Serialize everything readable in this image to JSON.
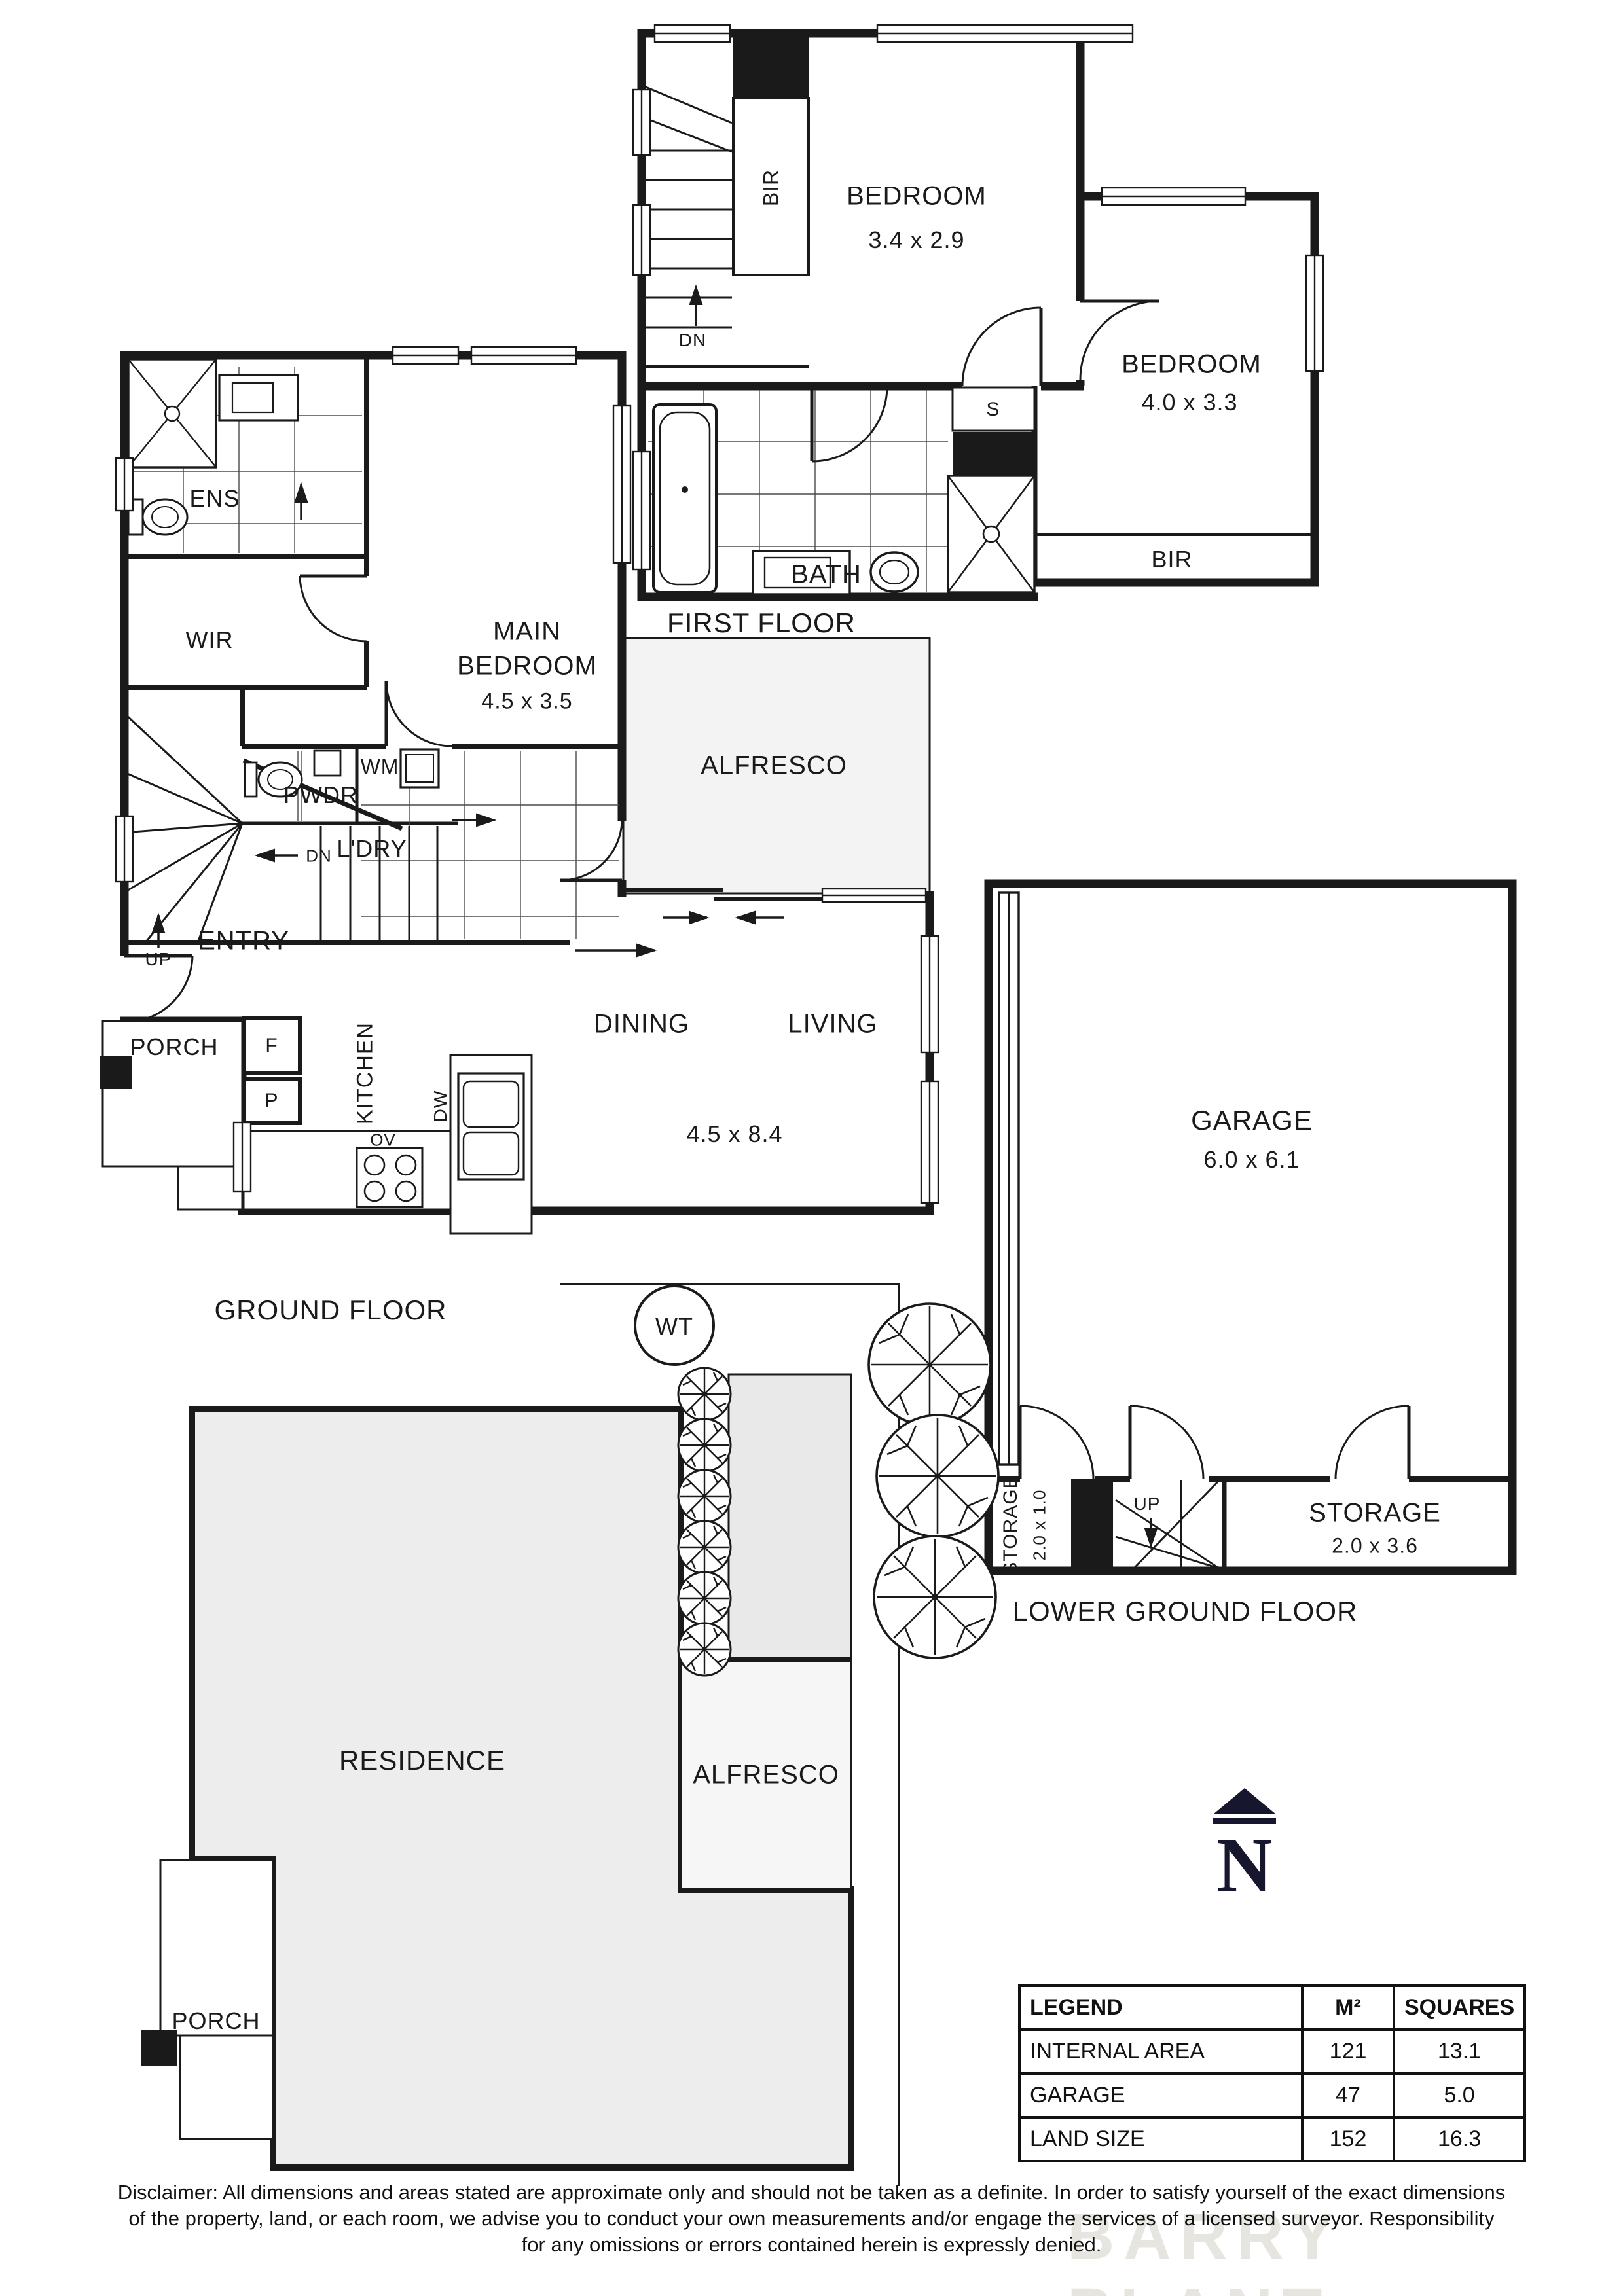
{
  "labels": {
    "ff": {
      "title": "FIRST FLOOR",
      "bedroom1": "BEDROOM",
      "bedroom1_dims": "3.4 x 2.9",
      "bedroom2": "BEDROOM",
      "bedroom2_dims": "4.0 x 3.3",
      "bath": "BATH",
      "bir_stair": "BIR",
      "bir_robe": "BIR",
      "linen": "S",
      "dn": "DN"
    },
    "gf": {
      "title": "GROUND FLOOR",
      "ens": "ENS",
      "wir": "WIR",
      "main_line1": "MAIN",
      "main_line2": "BEDROOM",
      "main_dims": "4.5 x 3.5",
      "pwdr": "PWDR",
      "wm": "WM",
      "ldry": "L'DRY",
      "dn": "DN",
      "up": "UP",
      "entry": "ENTRY",
      "porch": "PORCH",
      "fridge": "F",
      "pantry": "P",
      "kitchen": "KITCHEN",
      "dw": "DW",
      "ov": "OV",
      "dining": "DINING",
      "living": "LIVING",
      "living_dims": "4.5 x 8.4",
      "alfresco": "ALFRESCO"
    },
    "lg": {
      "title": "LOWER GROUND FLOOR",
      "garage": "GARAGE",
      "garage_dims": "6.0 x 6.1",
      "storage1": "STORAGE",
      "storage1_dims": "2.0 x 1.0",
      "up": "UP",
      "storage2": "STORAGE",
      "storage2_dims": "2.0 x 3.6"
    },
    "site": {
      "residence": "RESIDENCE",
      "alfresco": "ALFRESCO",
      "porch": "PORCH",
      "wt": "WT"
    }
  },
  "north": {
    "letter": "N"
  },
  "legend": {
    "headers": [
      "LEGEND",
      "M²",
      "SQUARES"
    ],
    "rows": [
      {
        "label": "INTERNAL AREA",
        "m2": "121",
        "squares": "13.1"
      },
      {
        "label": "GARAGE",
        "m2": "47",
        "squares": "5.0"
      },
      {
        "label": "LAND SIZE",
        "m2": "152",
        "squares": "16.3"
      }
    ]
  },
  "disclaimer": {
    "line1": "Disclaimer: All dimensions and areas stated are approximate only and should not be taken as a definite. In order to satisfy yourself of the exact dimensions",
    "line2": "of the property, land, or each room, we advise you to conduct your own measurements and/or engage the services of a licensed surveyor. Responsibility",
    "line3": "for any omissions or errors contained herein is expressly denied."
  },
  "watermark": "BARRY PLANT",
  "colors": {
    "line": "#1a1a1a",
    "navy": "#16162e",
    "alfresco_fill": "#f3f3f3",
    "residence_fill": "#ededed"
  }
}
